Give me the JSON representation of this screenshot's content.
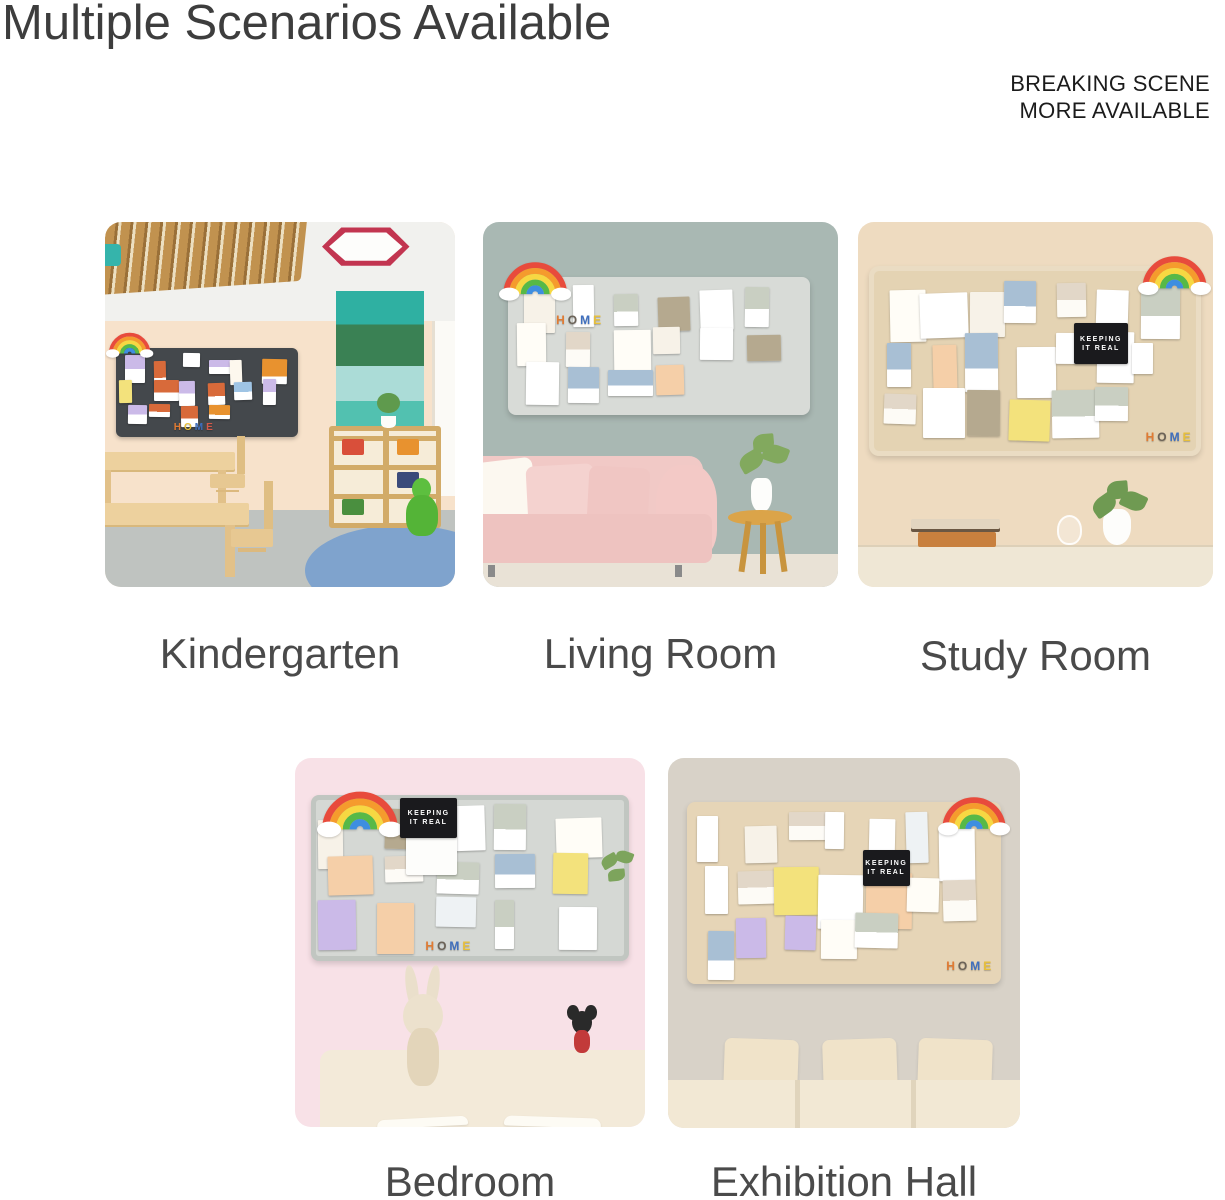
{
  "page": {
    "title": "Multiple Scenarios Available",
    "corner_note": {
      "line1": "BREAKING SCENE",
      "line2": "MORE AVAILABLE"
    }
  },
  "scenes": [
    {
      "label": "Kindergarten"
    },
    {
      "label": "Living Room"
    },
    {
      "label": "Study Room"
    },
    {
      "label": "Bedroom"
    },
    {
      "label": "Exhibition Hall"
    }
  ],
  "board_text": {
    "keeping_card": {
      "line1": "KEEPING",
      "line2": "IT REAL"
    },
    "home_letters": [
      "H",
      "O",
      "M",
      "E"
    ]
  },
  "icons": {
    "rainbow": "rainbow-cloud-sticker"
  },
  "palette": {
    "page_bg": "#ffffff",
    "title_text": "#3d3d3d",
    "label_text": "#4a4a4a",
    "corner_text": "#1b1b1b",
    "kindergarten_wall": "#f7e2cb",
    "kindergarten_board": "#44484c",
    "accent_stripes": [
      "#2fb0a2",
      "#3a8154",
      "#abdcd7",
      "#52c1b0",
      "#3f9a61"
    ],
    "living_room_wall": "#a9b8b3",
    "living_room_board": "#d8dbd7",
    "sofa_pink": "#f1c9c6",
    "study_wall": "#eedbc0",
    "study_board": "#e4d3b3",
    "bedroom_wall": "#f8e1e7",
    "bedroom_board": "#d5d8d4",
    "exhibition_wall": "#d8d2c8",
    "exhibition_board": "#e6d5b7",
    "rainbow_arcs": [
      "#e84b3c",
      "#f59b2d",
      "#f7d842",
      "#57b947",
      "#3e8ee0"
    ]
  }
}
